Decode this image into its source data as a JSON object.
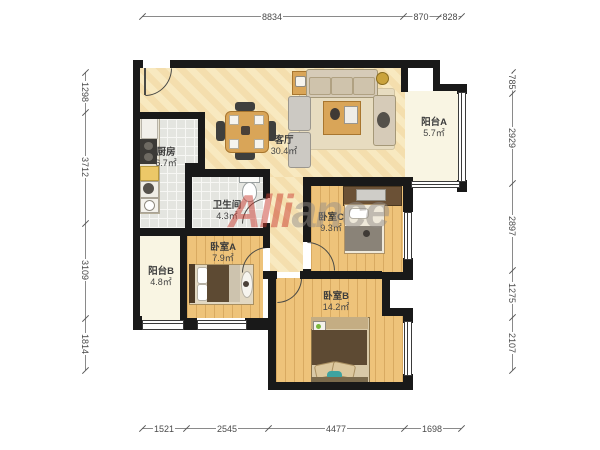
{
  "watermark": {
    "text": "Alliance",
    "part1": "Alli",
    "part2": "ance"
  },
  "rooms": {
    "kitchen": {
      "name": "厨房",
      "area": "6.7㎡"
    },
    "living": {
      "name": "客厅",
      "area": "30.4㎡"
    },
    "balcony_a": {
      "name": "阳台A",
      "area": "5.7㎡"
    },
    "bathroom": {
      "name": "卫生间",
      "area": "4.3㎡"
    },
    "bedroom_a": {
      "name": "卧室A",
      "area": "7.9㎡"
    },
    "bedroom_b": {
      "name": "卧室B",
      "area": "14.2㎡"
    },
    "bedroom_c": {
      "name": "卧室C",
      "area": "9.3㎡"
    },
    "balcony_b": {
      "name": "阳台B",
      "area": "4.8㎡"
    }
  },
  "dimensions": {
    "top": [
      "8834",
      "870",
      "828"
    ],
    "bottom": [
      "1521",
      "2545",
      "4477",
      "1698"
    ],
    "left": [
      "1298",
      "3712",
      "3109",
      "1814"
    ],
    "right": [
      "785",
      "2929",
      "2897",
      "1275",
      "2107"
    ]
  },
  "colors": {
    "wall": "#191919",
    "living_floor": "#f8e9c0",
    "wood_floor": "#eec37a",
    "tile_floor": "#e4e5e0",
    "balcony_floor": "#f9f5e3",
    "watermark_red": "#ca3c30",
    "watermark_gray": "#948e88",
    "dimension_text": "#4a4a4a"
  }
}
